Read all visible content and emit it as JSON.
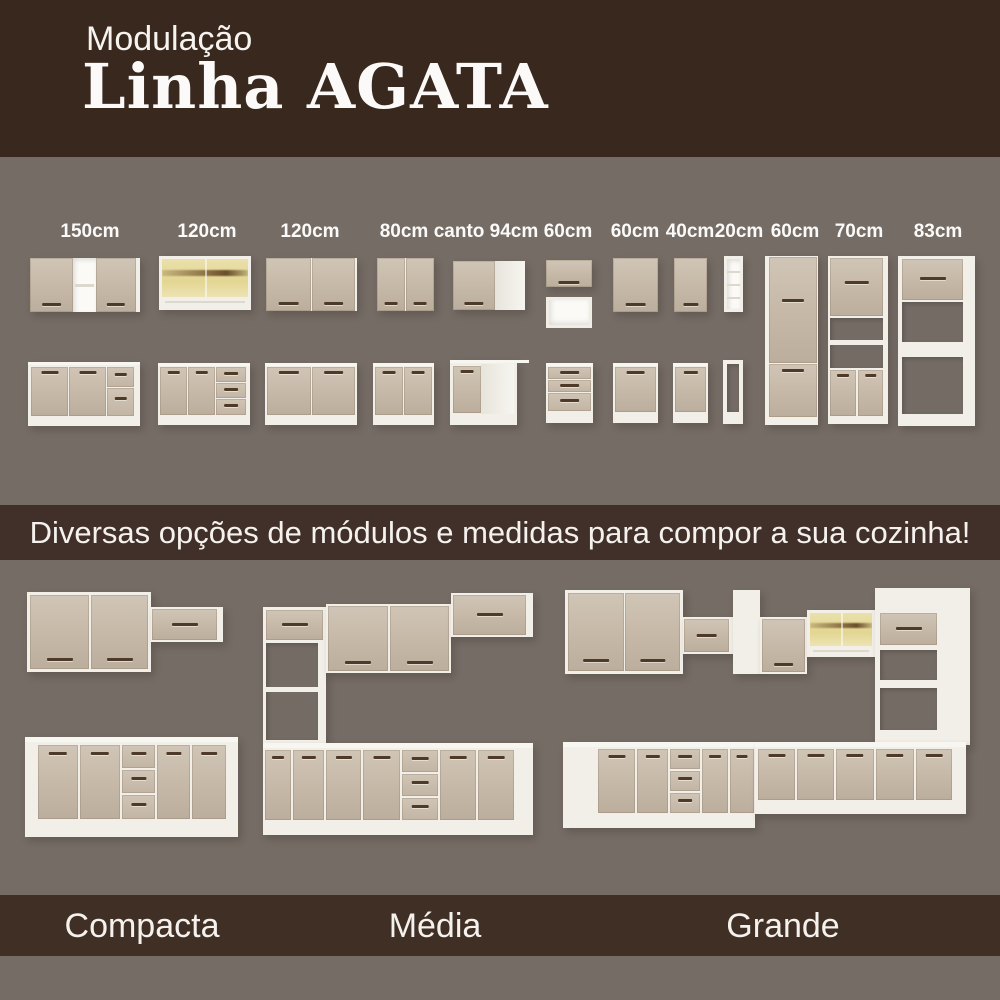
{
  "header": {
    "kicker": "Modulação",
    "title": "Linha AGATA"
  },
  "banner": {
    "text": "Diversas opções de módulos e medidas para compor a sua cozinha!"
  },
  "module_labels": [
    "150cm",
    "120cm",
    "120cm",
    "80cm",
    "canto 94cm",
    "60cm",
    "60cm",
    "40cm",
    "20cm",
    "60cm",
    "70cm",
    "83cm"
  ],
  "kitchen_labels": [
    "Compacta",
    "Média",
    "Grande"
  ],
  "colors": {
    "background": "#756c65",
    "header_brown": "#38281e",
    "banner_brown": "#41302a",
    "footer_brown": "#402f25",
    "door_beige": "#c6b8a7",
    "carcass_white": "#f2efe8",
    "handle_brown": "#4d3a28",
    "glass_amber": "#e3d693",
    "text_white": "#f5f2ee"
  }
}
